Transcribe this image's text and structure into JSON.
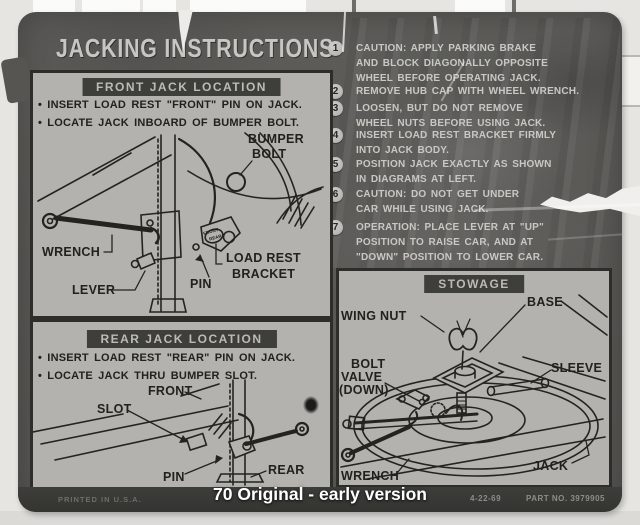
{
  "caption": "70 Original - early version",
  "label": {
    "title": "JACKING INSTRUCTIONS",
    "instructions": [
      {
        "num": "1",
        "lines": [
          "CAUTION: APPLY PARKING BRAKE",
          "AND BLOCK DIAGONALLY OPPOSITE",
          "WHEEL BEFORE OPERATING JACK."
        ]
      },
      {
        "num": "2",
        "lines": [
          "REMOVE HUB CAP WITH WHEEL WRENCH."
        ]
      },
      {
        "num": "3",
        "lines": [
          "LOOSEN, BUT DO NOT REMOVE",
          "WHEEL NUTS BEFORE USING JACK."
        ]
      },
      {
        "num": "4",
        "lines": [
          "INSERT LOAD REST BRACKET FIRMLY",
          "INTO JACK BODY."
        ]
      },
      {
        "num": "5",
        "lines": [
          "POSITION JACK EXACTLY AS SHOWN",
          "IN DIAGRAMS AT LEFT."
        ]
      },
      {
        "num": "6",
        "lines": [
          "CAUTION: DO NOT GET UNDER",
          "CAR WHILE USING JACK."
        ]
      },
      {
        "num": "7",
        "lines": [
          "OPERATION: PLACE LEVER AT \"UP\"",
          "POSITION TO RAISE CAR, AND AT",
          "\"DOWN\" POSITION TO LOWER CAR."
        ]
      }
    ],
    "front_jack": {
      "header": "FRONT JACK LOCATION",
      "bullets": [
        "• INSERT LOAD REST \"FRONT\" PIN ON JACK.",
        "• LOCATE JACK INBOARD OF BUMPER BOLT."
      ],
      "labels": {
        "bumper_bolt_line1": "BUMPER",
        "bumper_bolt_line2": "BOLT",
        "wrench": "WRENCH",
        "lever": "LEVER",
        "pin": "PIN",
        "load_rest_line1": "LOAD REST",
        "load_rest_line2": "BRACKET",
        "stamp_front": "FRONT",
        "stamp_rear": "REAR"
      }
    },
    "rear_jack": {
      "header": "REAR JACK LOCATION",
      "bullets": [
        "• INSERT LOAD REST \"REAR\" PIN ON JACK.",
        "• LOCATE JACK THRU BUMPER SLOT."
      ],
      "labels": {
        "front": "FRONT",
        "slot": "SLOT",
        "pin": "PIN",
        "rear": "REAR"
      }
    },
    "stowage": {
      "header": "STOWAGE",
      "labels": {
        "wing_nut": "WING NUT",
        "base": "BASE",
        "bolt": "BOLT",
        "valve": "VALVE",
        "down": "(DOWN)",
        "sleeve": "SLEEVE",
        "wrench": "WRENCH",
        "jack": "JACK"
      }
    },
    "footer": {
      "printed": "PRINTED IN U.S.A.",
      "date": "4-22-69",
      "part_no": "PART NO. 3979905"
    }
  },
  "colors": {
    "label_bg": "#5b5a57",
    "panel_bg": "#b3b2ae",
    "panel_border": "#2d2d2a",
    "header_box_bg": "#3e3e3b",
    "dark_text": "#21211d",
    "light_text": "#c9c8c4",
    "footer_strip_bg": "#3b3b38",
    "caption_text": "#ffffff",
    "scan_background": "#e6e5e2"
  }
}
